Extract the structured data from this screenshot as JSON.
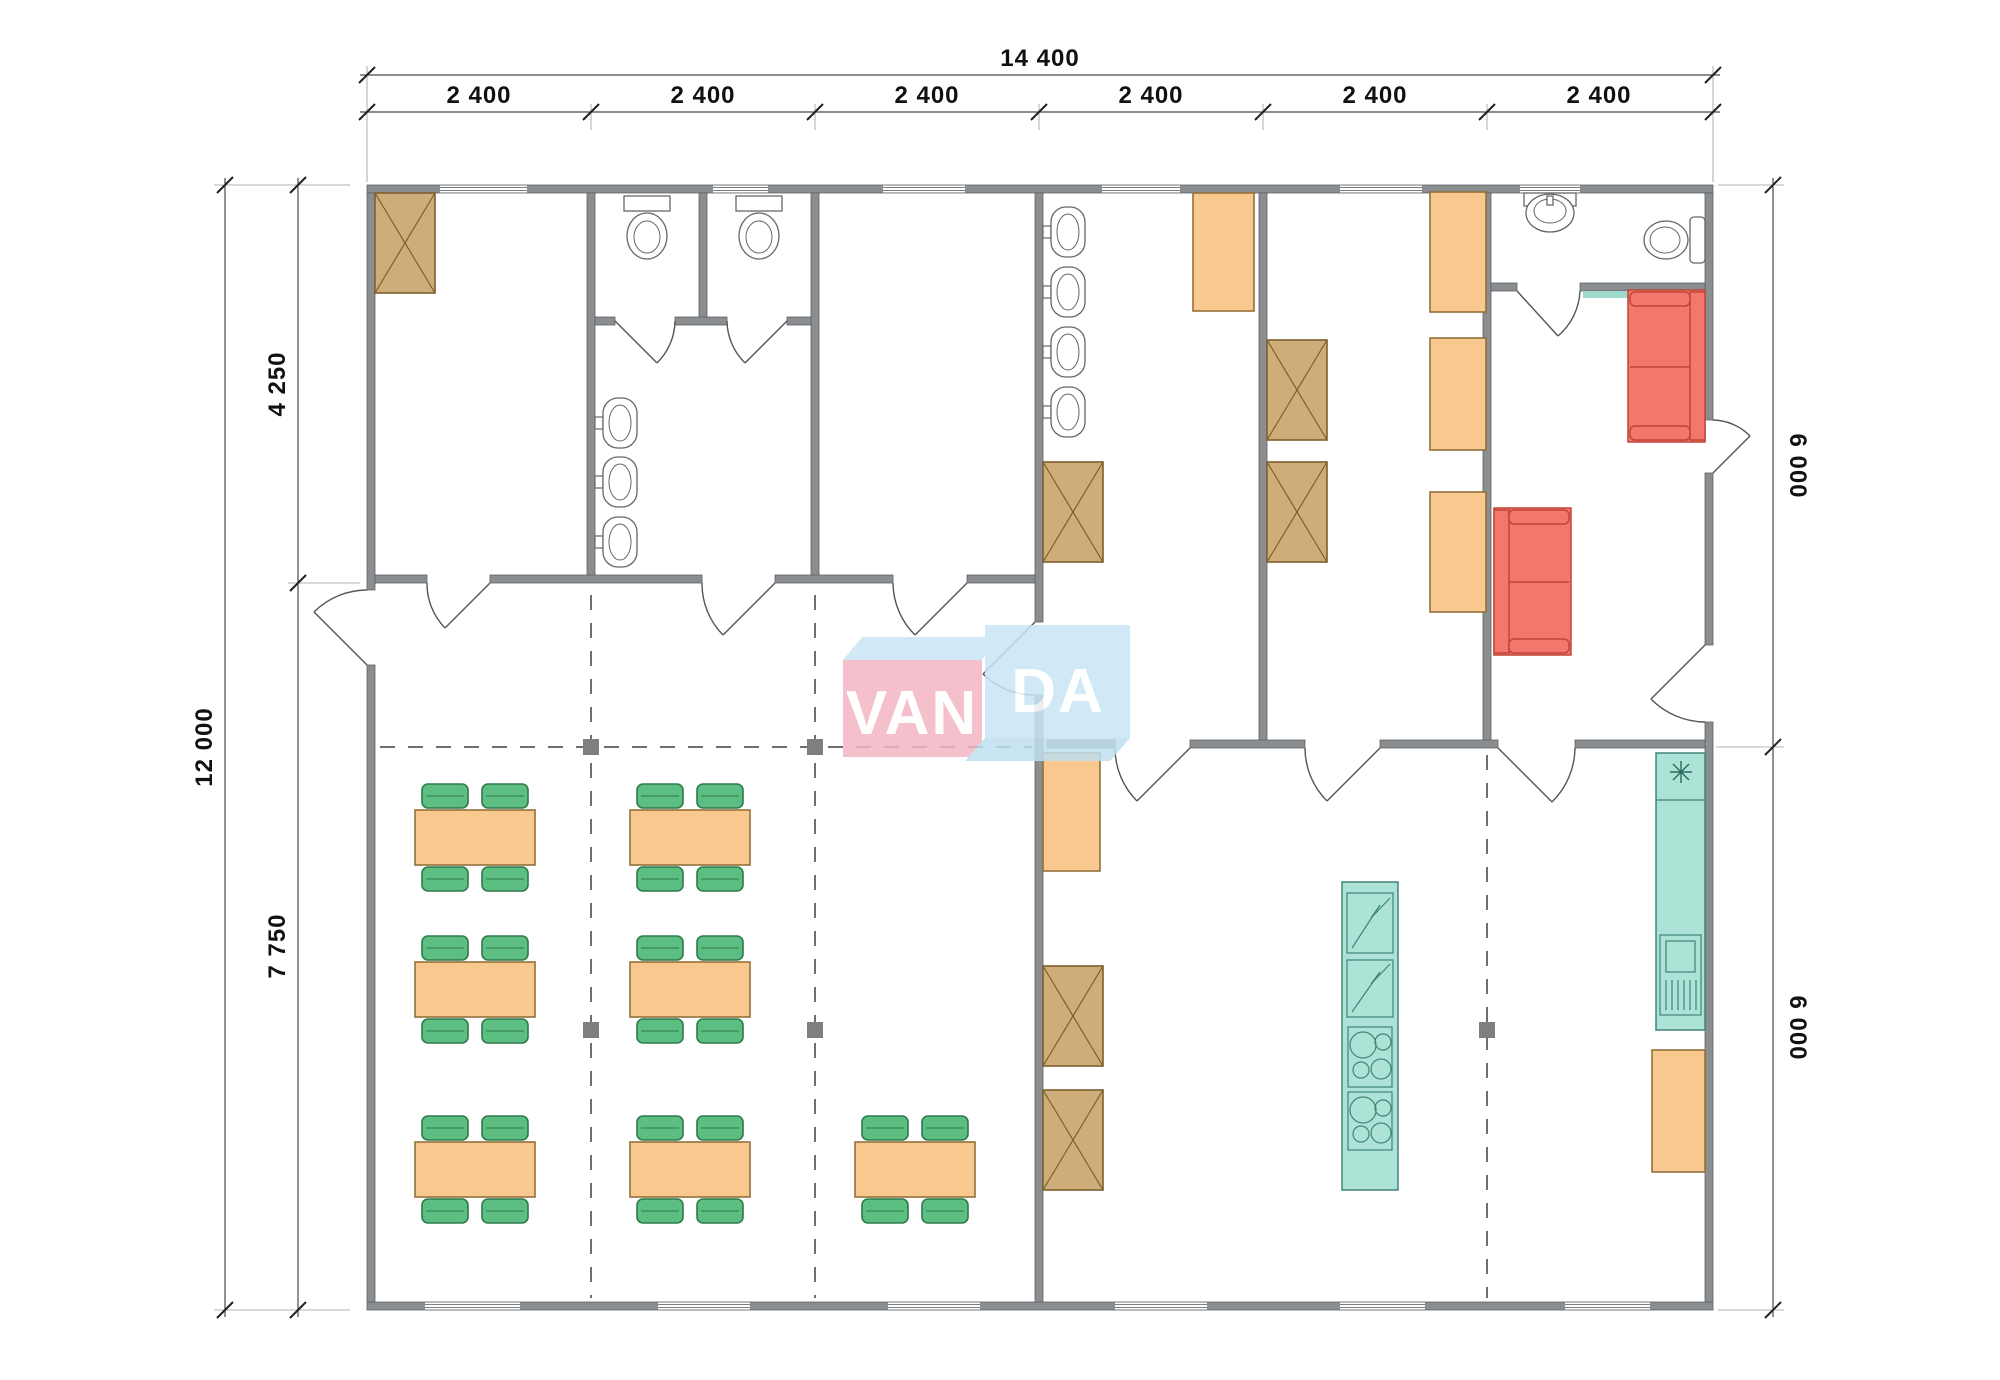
{
  "logo": {
    "left": "VAN",
    "right": "DA"
  },
  "dimensions": {
    "top_total": "14 400",
    "top_bays": [
      "2 400",
      "2 400",
      "2 400",
      "2 400",
      "2 400",
      "2 400"
    ],
    "left_total": "12 000",
    "left_upper": "4 250",
    "left_lower": "7 750",
    "right_upper": "6 000",
    "right_lower": "6 000"
  },
  "colors": {
    "wall": "#8A8E91",
    "table": "#F8C88E",
    "chair": "#5DBE82",
    "storage_box": "#CDAD79",
    "locker": "#FBC27E",
    "kitchen_unit": "#ACE3D6",
    "sofa": "#F2776C",
    "logo_pink": "#F2B6C2",
    "logo_blue": "#C9E5F5"
  },
  "inventory": {
    "dining_tables": 7,
    "chairs": 28,
    "toilets": 3,
    "wash_basins": 8,
    "storage_boxes": 6,
    "lockers": 6,
    "sofas": 2,
    "fridges": 2,
    "cooktops": 2,
    "dishwasher": 1,
    "kitchen_sink": 1
  }
}
